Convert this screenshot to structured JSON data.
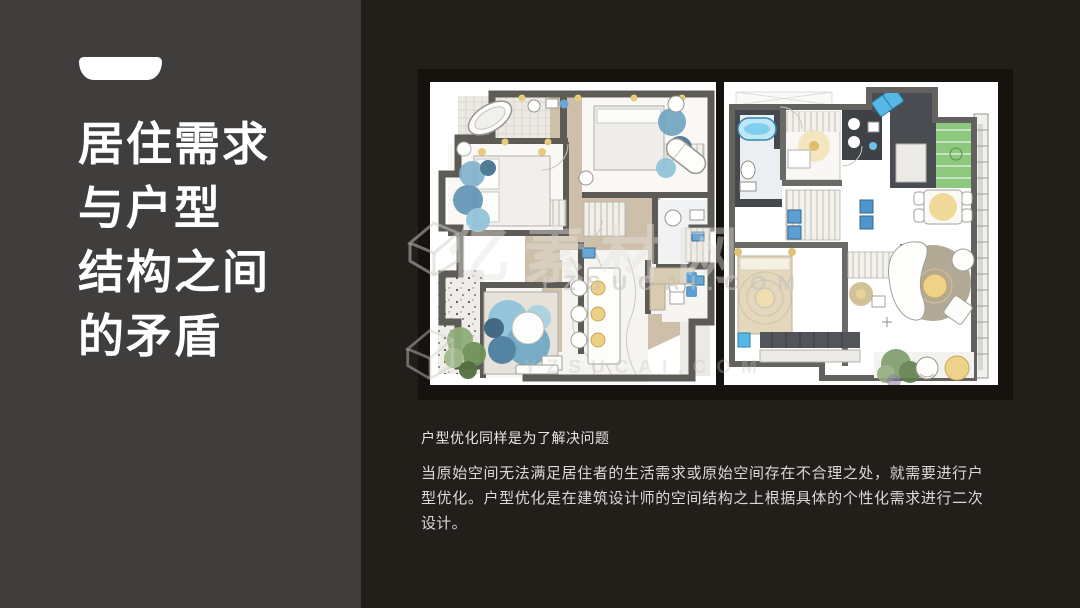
{
  "slide": {
    "left_panel": {
      "title_lines": [
        "居住需求",
        "与户型",
        "结构之间",
        "的矛盾"
      ]
    },
    "watermark": {
      "brand": "亿素材网",
      "domain": "YZSUCAI.COM"
    },
    "caption": {
      "heading": "户型优化同样是为了解决问题",
      "body": "当原始空间无法满足居住者的生活需求或原始空间存在不合理之处，就需要进行户型优化。户型优化是在建筑设计师的空间结构之上根据具体的个性化需求进行二次设计。"
    },
    "colors": {
      "slide_background": "#221f1a",
      "panel_background": "#403e3d",
      "title_text": "#ffffff",
      "caption_text": "#dbd9d5",
      "plan_wall_gray": "#5d5b55",
      "plan_floor_beige": "#cdbfa9",
      "plan_accent_blue": "#7fb2cd",
      "plan_accent_green": "#8cc87d",
      "plan_accent_yellow": "#ecd185"
    }
  }
}
